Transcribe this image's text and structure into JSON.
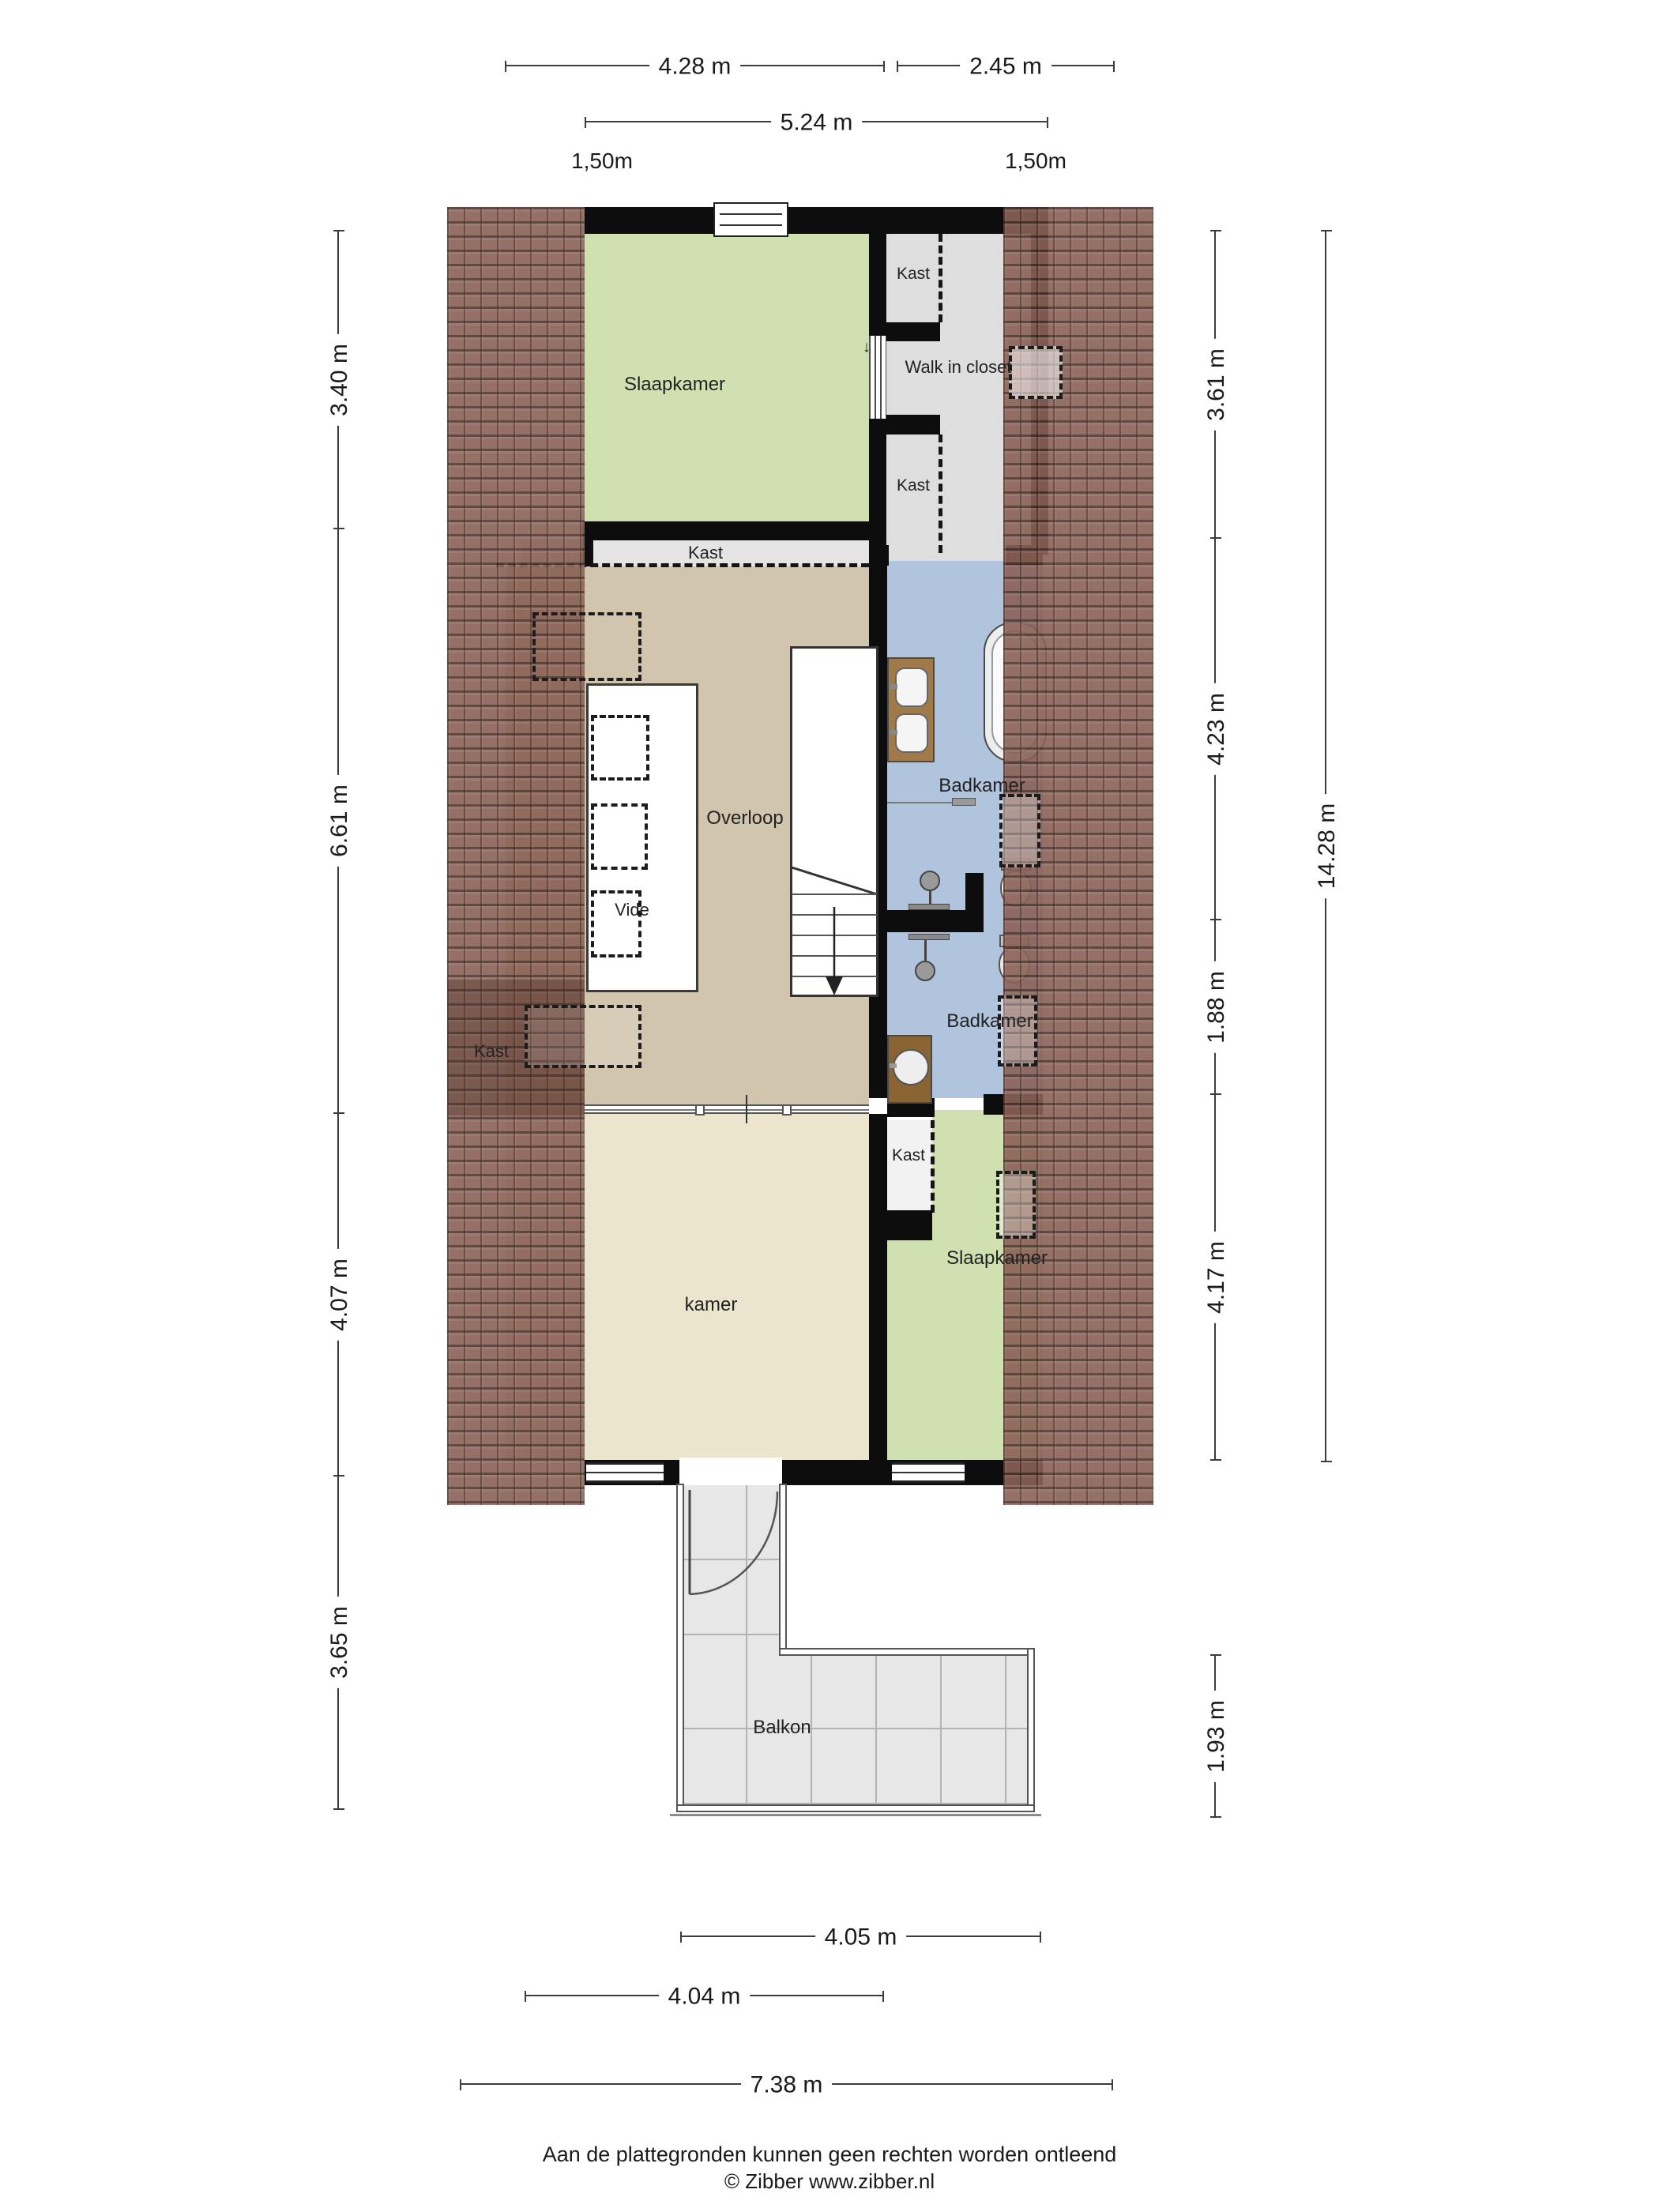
{
  "plan": {
    "rooms": {
      "slaapkamer": "Slaapkamer",
      "walk_in_closet": "Walk in closet",
      "kast": "Kast",
      "overloop": "Overloop",
      "vide": "Vide",
      "badkamer": "Badkamer",
      "kamer": "kamer",
      "balkon": "Balkon"
    },
    "door_direction_arrow": "↓"
  },
  "dims": {
    "top": [
      "4.28 m",
      "2.45 m",
      "5.24 m"
    ],
    "knee": [
      "1,50m",
      "1,50m"
    ],
    "left": [
      "3.40 m",
      "6.61 m",
      "4.07 m",
      "3.65 m"
    ],
    "right": [
      "3.61 m",
      "4.23 m",
      "1.88 m",
      "4.17 m",
      "1.93 m"
    ],
    "total": "14.28 m",
    "bottom": [
      "4.05 m",
      "4.04 m",
      "7.38 m"
    ]
  },
  "footer": {
    "disclaimer": "Aan de plattegronden kunnen geen rechten worden ontleend",
    "copyright": "© Zibber www.zibber.nl"
  },
  "colors": {
    "bedroom_green": "#cfe1b0",
    "hall_tan": "#d2c5ae",
    "room_cream": "#eae5cc",
    "bath_blue": "#b0c4dd",
    "closet_gray": "#e0e0e0",
    "balcony_gray": "#e7e7e7",
    "wall_black": "#0d0d0d",
    "roof_brown": "#8a6156",
    "vanity_wood": "#a07a48"
  }
}
